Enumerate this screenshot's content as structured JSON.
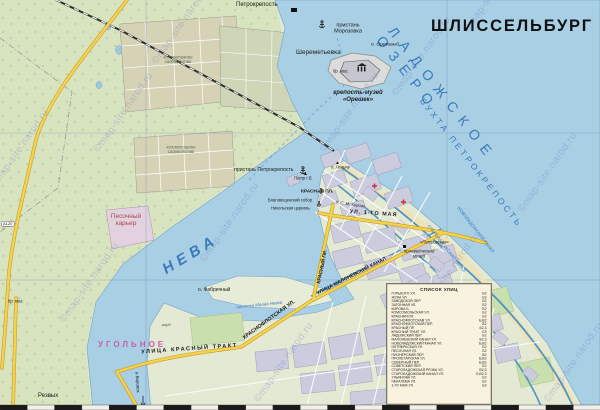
{
  "title": "ШЛИССЕЛЬБУРГ",
  "watermark": "©map-site.narod.ru",
  "road_badge": "А120",
  "colors": {
    "water": "#A9CFE4",
    "land": "#E3E9D2",
    "forest": "#D8E4C0",
    "city_block": "#CBCDDF",
    "road_yellow": "#F4D44F",
    "label_blue": "#3B79BC",
    "settlement_magenta": "#C75FA8",
    "legend_bg": "#F8F2DE"
  },
  "map_labels": [
    {
      "id": "lake-name",
      "text": "ЛАДОЖСКОЕ ОЗЕРО",
      "x": 397,
      "y": 24,
      "fs": 14,
      "rot": 52,
      "ls": 8.5,
      "color": "#3B79BC"
    },
    {
      "id": "bay-name",
      "text": "БУХТА ПЕТРОКРЕПОСТЬ",
      "x": 425,
      "y": 97,
      "fs": 8.5,
      "rot": 52,
      "ls": 3,
      "color": "#3B79BC"
    },
    {
      "id": "neva-river",
      "text": "НЕВА",
      "x": 160,
      "y": 264,
      "fs": 15,
      "rot": -31,
      "ls": 5,
      "b": 1,
      "i": 1,
      "color": "#3B79BC"
    },
    {
      "id": "sheremetyevka",
      "text": "Шереметьевка",
      "x": 296,
      "y": 49,
      "fs": 6.5
    },
    {
      "id": "pier-morozovka",
      "text": "пристань\nМорозовка",
      "x": 326,
      "y": 22,
      "fs": 5.5,
      "w": 44
    },
    {
      "id": "petrokrepost-station",
      "text": "Петрокрепость",
      "x": 236,
      "y": 2,
      "fs": 6
    },
    {
      "id": "orehovy-island",
      "text": "о. Ореховый",
      "x": 371,
      "y": 42,
      "fs": 4.8,
      "i": 1
    },
    {
      "id": "fortress-museum",
      "text": "крепость-музей\n«Орешек»",
      "x": 330,
      "y": 90,
      "fs": 6,
      "b": 1,
      "i": 1,
      "w": 56
    },
    {
      "id": "brat-mogila",
      "text": "бр. мог.",
      "x": 333,
      "y": 69,
      "fs": 4.2,
      "i": 1
    },
    {
      "id": "brat-mogila-2",
      "text": "бр. мог.",
      "x": 8,
      "y": 299,
      "fs": 4.2,
      "i": 1
    },
    {
      "id": "pier-petrokrepost",
      "text": "пристань Петрокрепость",
      "x": 234,
      "y": 167,
      "fs": 5.2
    },
    {
      "id": "peter-monument",
      "text": "Петр I В.",
      "x": 294,
      "y": 176,
      "fs": 4.2,
      "i": 1
    },
    {
      "id": "lenin-monument",
      "text": "п. Ленину",
      "x": 331,
      "y": 165,
      "fs": 4.2,
      "i": 1
    },
    {
      "id": "krasnaya-square",
      "text": "КРАСНАЯ ПЛ.",
      "x": 301,
      "y": 189,
      "fs": 4.8,
      "b": 1
    },
    {
      "id": "cathedral",
      "text": "Благовещенский собор",
      "x": 268,
      "y": 198,
      "fs": 4.1
    },
    {
      "id": "nikolskaya-church",
      "text": "Никольская церковь",
      "x": 271,
      "y": 206,
      "fs": 4.1
    },
    {
      "id": "kirova-blvd",
      "text": "б. С. М. Кирова",
      "x": 336,
      "y": 200,
      "fs": 4.2,
      "i": 1,
      "rot": 8
    },
    {
      "id": "may-1-street",
      "text": "УЛ. 1-ГО МАЯ",
      "x": 350,
      "y": 209,
      "fs": 5.4,
      "b": 1,
      "rot": 4,
      "ls": 1
    },
    {
      "id": "malonevsky-street",
      "text": "УЛИЦА МАЛОНЕВСКИЙ КАНАЛ",
      "x": 316,
      "y": 291,
      "fs": 5,
      "b": 1,
      "rot": -27
    },
    {
      "id": "krasny-prospekt",
      "text": "КРАСНЫЙ ПР.",
      "x": 316,
      "y": 283,
      "fs": 5,
      "b": 1,
      "rot": -78
    },
    {
      "id": "krasnoflotskaya-street",
      "text": "КРАСНОФЛОТСКАЯ УЛ.",
      "x": 242,
      "y": 336,
      "fs": 5.4,
      "b": 1,
      "rot": -36
    },
    {
      "id": "krasny-trakt",
      "text": "УЛИЦА КРАСНЫЙ ТРАКТ",
      "x": 141,
      "y": 349,
      "fs": 5.6,
      "b": 1,
      "rot": -4,
      "ls": 1.5
    },
    {
      "id": "ugolnoe",
      "text": "УГОЛЬНОЕ",
      "x": 98,
      "y": 341,
      "fs": 8,
      "b": 1,
      "ls": 3,
      "color": "#C75FA8"
    },
    {
      "id": "novoladozhsky-canal",
      "text": "НОВОЛАДОЖСКИЙ КАНАЛ",
      "x": 460,
      "y": 206,
      "fs": 4.4,
      "rot": 52,
      "color": "#3B79BC"
    },
    {
      "id": "staroladozhsky-canal",
      "text": "СТАРОЛАДОЖСКИЙ КАНАЛ",
      "x": 430,
      "y": 224,
      "fs": 4.4,
      "rot": 52,
      "color": "#3B79BC"
    },
    {
      "id": "protoka",
      "text": "протока Малая Невка",
      "x": 236,
      "y": 305,
      "fs": 4.4,
      "i": 1,
      "rot": -6,
      "color": "#3B79BC"
    },
    {
      "id": "fabrichny-island",
      "text": "о. Фабричный",
      "x": 198,
      "y": 287,
      "fs": 5
    },
    {
      "id": "sand-quarry",
      "text": "Песочный\nкарьер",
      "x": 103,
      "y": 213,
      "fs": 6.5,
      "w": 46,
      "color": "#A34848"
    },
    {
      "id": "sadovodstvo-1",
      "text": "коллективное\nсадоводство",
      "x": 147,
      "y": 55,
      "fs": 4.3,
      "i": 1,
      "w": 62,
      "color": "#5A6A50"
    },
    {
      "id": "sadovodstvo-2",
      "text": "коллективное\nсадоводство",
      "x": 150,
      "y": 145,
      "fs": 4.3,
      "i": 1,
      "w": 62,
      "color": "#5A6A50"
    },
    {
      "id": "rezvykh",
      "text": "Резвых",
      "x": 38,
      "y": 393,
      "fs": 6
    },
    {
      "id": "to-kirovsk",
      "text": "в Кировск",
      "x": 139,
      "y": 372,
      "fs": 4.5,
      "rot": 86
    },
    {
      "id": "club",
      "text": "клуб",
      "x": 162,
      "y": 323,
      "fs": 4,
      "i": 1,
      "color": "#444444"
    },
    {
      "id": "museum",
      "text": "Краеведческий\nмузей",
      "x": 396,
      "y": 249,
      "fs": 4.4,
      "i": 1,
      "w": 46
    },
    {
      "id": "petrovskaya",
      "text": "«Петровская»",
      "x": 420,
      "y": 240,
      "fs": 4.2,
      "i": 1
    }
  ],
  "legend": {
    "title": "СПИСОК УЛИЦ",
    "entries": [
      {
        "name": "ГОРЬКОГО УЛ.",
        "grid": "Б2"
      },
      {
        "name": "ЖУКА УЛ.",
        "grid": "Б2"
      },
      {
        "name": "ЗАВОДСКОЙ ПЕР.",
        "grid": "Б2"
      },
      {
        "name": "ЗАТОННАЯ УЛ.",
        "grid": "Б2"
      },
      {
        "name": "КИРОВА Б.",
        "grid": "Б2"
      },
      {
        "name": "КОМСОМОЛЬСКАЯ УЛ.",
        "grid": "Б2"
      },
      {
        "name": "КРАСНАЯ ПЛ.",
        "grid": "Б2"
      },
      {
        "name": "КРАСНОФЛОТСКАЯ УЛ.",
        "grid": "Б,В2"
      },
      {
        "name": "КРАСНОФЛОТСКИЙ ПЕР.",
        "grid": "В2"
      },
      {
        "name": "КРАСНЫЙ ПР.",
        "grid": "Б2,3"
      },
      {
        "name": "КРАСНЫЙ ТРАКТ УЛ.",
        "grid": "Б3"
      },
      {
        "name": "ЛАДОЖСКИЙ ПЕР.",
        "grid": "Б2"
      },
      {
        "name": "МАЛОНЕВСКИЙ КАНАЛ УЛ.",
        "grid": "Б2,3"
      },
      {
        "name": "НОВОЛАДОЖСКИЙ КАНАЛ УЛ.",
        "grid": "Б,В2"
      },
      {
        "name": "ОКТЯБРЬСКАЯ УЛ.",
        "grid": "Б2"
      },
      {
        "name": "ПЕСОЧНАЯ УЛ.",
        "grid": "Б2"
      },
      {
        "name": "ПИОНЕРСКИЙ ПЕР.",
        "grid": "В2"
      },
      {
        "name": "ПРОЛЕТАРСКАЯ УЛ.",
        "grid": "Б,В2"
      },
      {
        "name": "СЕВЕРНЫЙ ПЕР.",
        "grid": "Б,В2"
      },
      {
        "name": "СОВЕТСКИЙ ПЕР.",
        "grid": "Б2"
      },
      {
        "name": "СТАРОЛАДОЖСКАЯ РЕЧКА УЛ.",
        "grid": "В2,3"
      },
      {
        "name": "СТАРОЛАДОЖСКИЙ КАНАЛ УЛ.",
        "grid": "Б,В2,3"
      },
      {
        "name": "УЛЬЯНОВА УЛ.",
        "grid": "Б2"
      },
      {
        "name": "ЧЕКАЛОВА УЛ.",
        "grid": "Б2"
      },
      {
        "name": "1-ГО МАЯ УЛ.",
        "grid": "Б2"
      }
    ]
  }
}
